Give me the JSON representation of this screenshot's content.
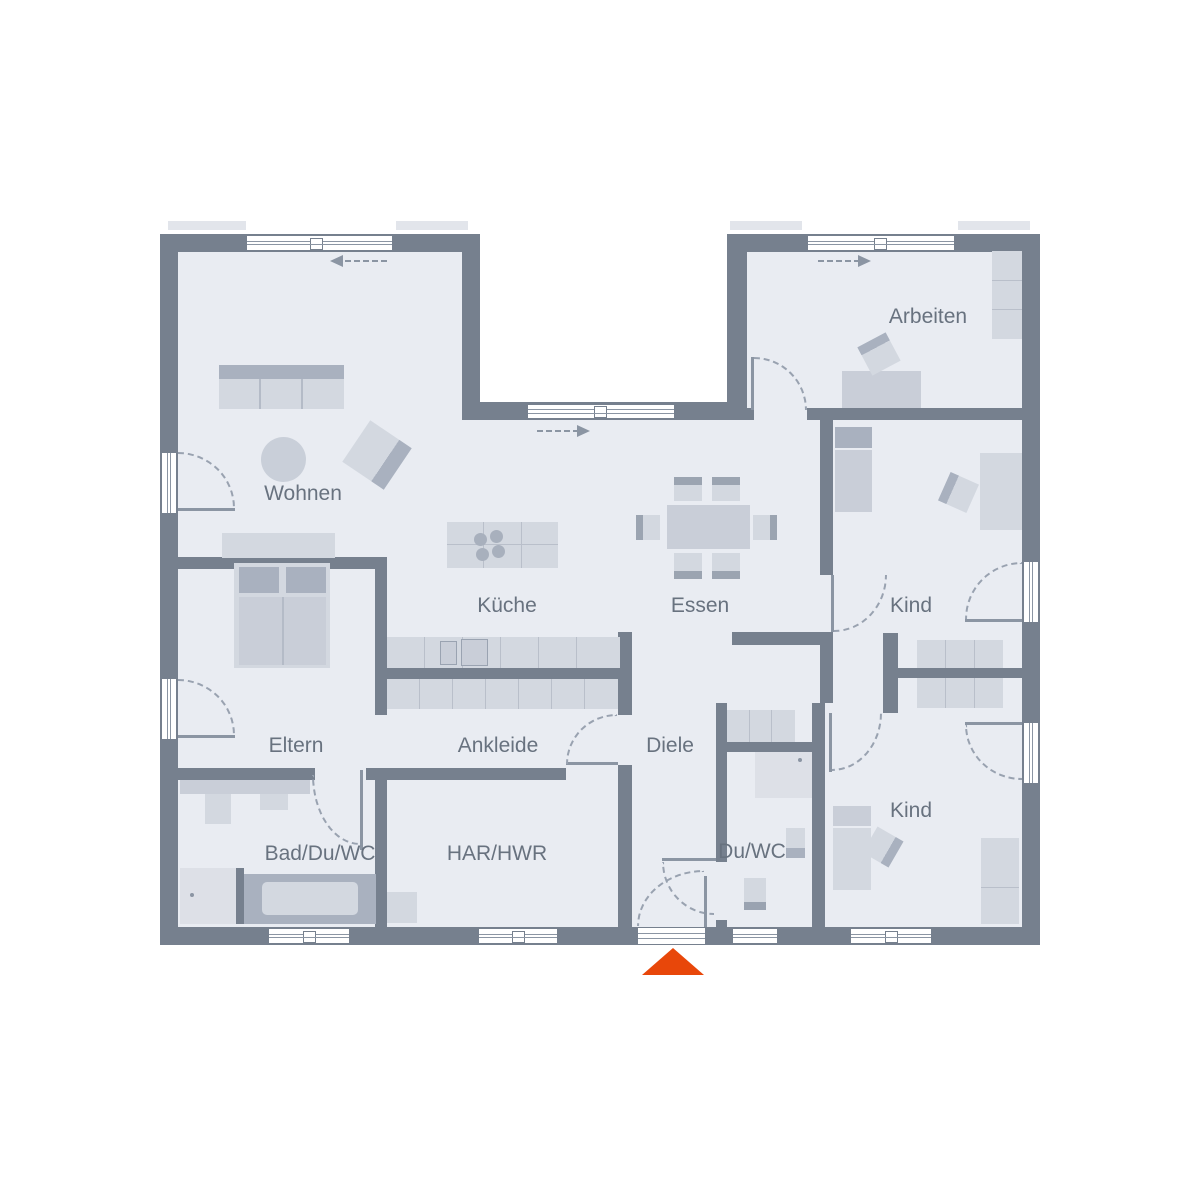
{
  "plan": {
    "type": "floorplan",
    "rooms": [
      {
        "id": "wohnen",
        "label": "Wohnen"
      },
      {
        "id": "kueche",
        "label": "Küche"
      },
      {
        "id": "essen",
        "label": "Essen"
      },
      {
        "id": "arbeiten",
        "label": "Arbeiten"
      },
      {
        "id": "kind1",
        "label": "Kind"
      },
      {
        "id": "kind2",
        "label": "Kind"
      },
      {
        "id": "eltern",
        "label": "Eltern"
      },
      {
        "id": "ankleide",
        "label": "Ankleide"
      },
      {
        "id": "diele",
        "label": "Diele"
      },
      {
        "id": "bad",
        "label": "Bad/Du/WC"
      },
      {
        "id": "har",
        "label": "HAR/HWR"
      },
      {
        "id": "duwc",
        "label": "Du/WC"
      }
    ],
    "colors": {
      "wall": "#76808e",
      "floor": "#e9ecf2",
      "furniture": "#d3d8e0",
      "furniture_dark": "#a9b1bf",
      "door_arc": "#99a2b0",
      "label_text": "#68727f",
      "entrance_accent": "#e8470a",
      "background": "#ffffff"
    },
    "icons": {
      "entrance_marker": "orange-triangle-up",
      "sliding_window_left": "dashed-arrow-left",
      "sliding_window_right": "dashed-arrow-right"
    }
  }
}
